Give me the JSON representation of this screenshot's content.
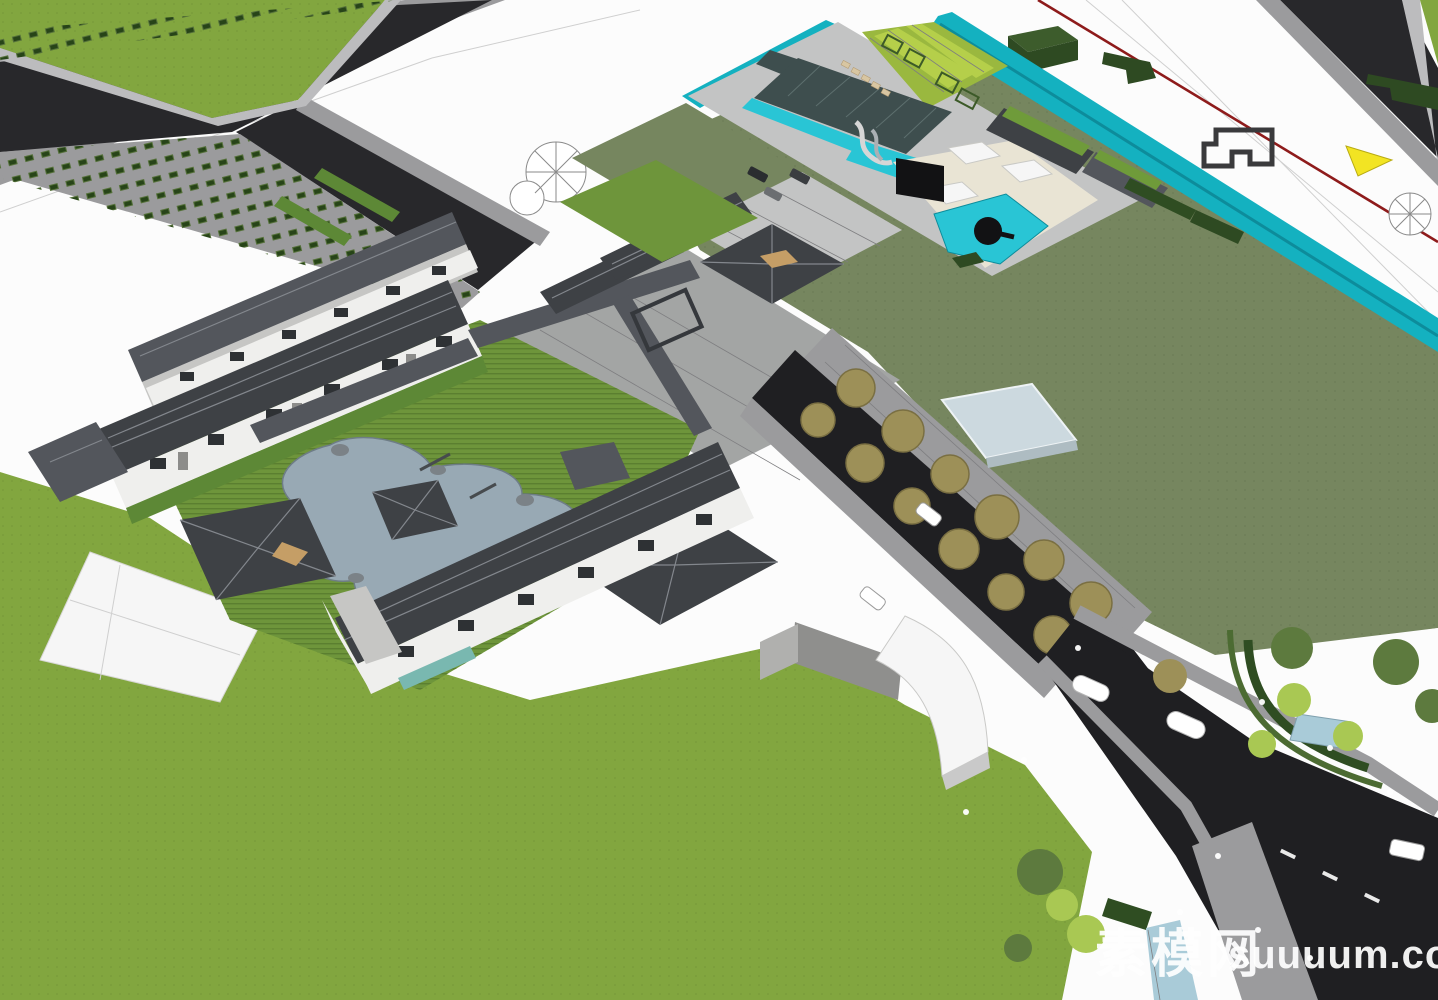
{
  "watermark": {
    "cjk": "素模网",
    "latin": "suuuum.com"
  },
  "colors": {
    "bg": "#fcfcfc",
    "lawn": "#82a63f",
    "lawn2": "#8db44a",
    "sage": "#76865f",
    "road": "#28282b",
    "road2": "#1f1f22",
    "sidewalk": "#9b9b9d",
    "curb": "#bcbcbe",
    "teal": "#14b1c0",
    "tealDark": "#0d8c9b",
    "red": "#8e1b1b",
    "roofDark": "#3e4145",
    "roofMid": "#53565c",
    "roofLight": "#6a6e74",
    "ridge": "#83878d",
    "wallWhite": "#efefed",
    "wallShade": "#c6c6c4",
    "glass": "#2e3134",
    "pond": "#98a9b4",
    "rock": "#7b8287",
    "poolDark": "#3e4e4e",
    "poolCyan": "#29c5d5",
    "deck": "#c3c4c4",
    "cream": "#e9e4d4",
    "stripeA": "#9ab83f",
    "stripeB": "#b5cf4a",
    "hedge": "#2f4d22",
    "gardenGreen": "#6e953b",
    "baseGreen": "#5d8836",
    "treeOlive": "#9d9058",
    "treeOliveDark": "#7a6f42",
    "treeGreen": "#5d7a3e",
    "treeBright": "#a9c853",
    "canopy": "#ccd9df",
    "waterPale": "#a9cbd8",
    "container": "#2e4a22",
    "containerTop": "#3d5c2c",
    "white": "#f6f6f6",
    "black": "#121214",
    "tan": "#c59e66",
    "wm": "#ffffff"
  },
  "scene": {
    "style": "sketchup-axonometric-render",
    "elements": [
      "perimeter-road",
      "street-sidewalk-hedges",
      "red-boundary-line",
      "canal",
      "amenity-pool-deck",
      "lap-pool",
      "water-slides",
      "leisure-pool",
      "clubhouse-terrace",
      "striped-sun-lawn",
      "green-roof-pavilions",
      "parking-court",
      "chinese-roof-residential-slabs",
      "courtyard-garden-pond",
      "garden-pavilions",
      "covered-corridors",
      "entry-gate-pavilion",
      "tree-lined-entry-drive",
      "arrival-canopy",
      "curved-white-canopy",
      "corner-pocket-park",
      "south-lawn",
      "white-plaza",
      "vehicles",
      "pedestrians"
    ]
  }
}
